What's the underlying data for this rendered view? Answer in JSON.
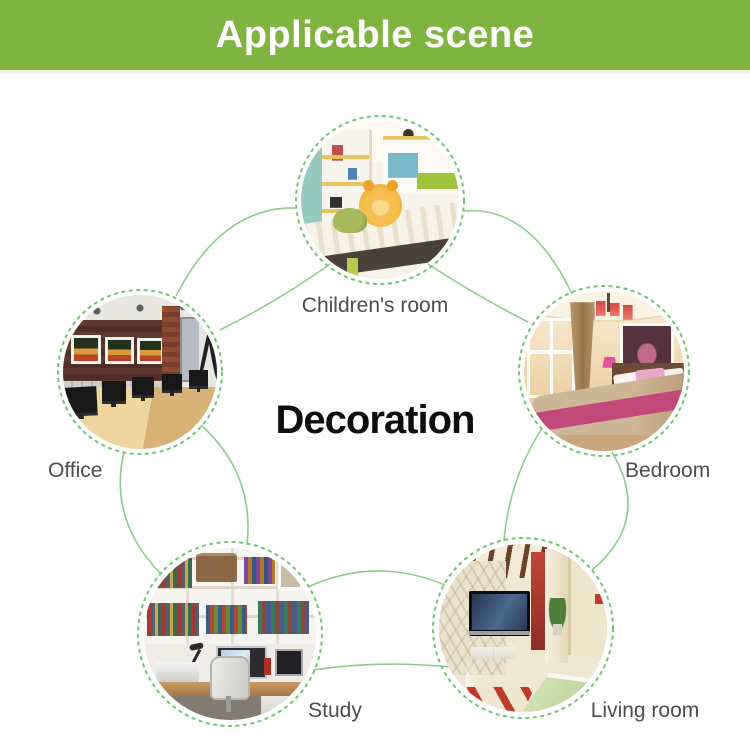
{
  "header": {
    "title": "Applicable scene"
  },
  "center_label": "Decoration",
  "scenes": [
    {
      "id": "childrens-room",
      "label": "Children's room"
    },
    {
      "id": "office",
      "label": "Office"
    },
    {
      "id": "bedroom",
      "label": "Bedroom"
    },
    {
      "id": "study",
      "label": "Study"
    },
    {
      "id": "living-room",
      "label": "Living room"
    }
  ],
  "colors": {
    "banner_green": "#80b441",
    "banner_text": "#ffffff",
    "connector_green": "#8bcd8b",
    "dashed_ring_green": "#6fc66f",
    "label_gray": "#4d4d4d",
    "title_black": "#0e0e0e",
    "background": "#ffffff"
  }
}
